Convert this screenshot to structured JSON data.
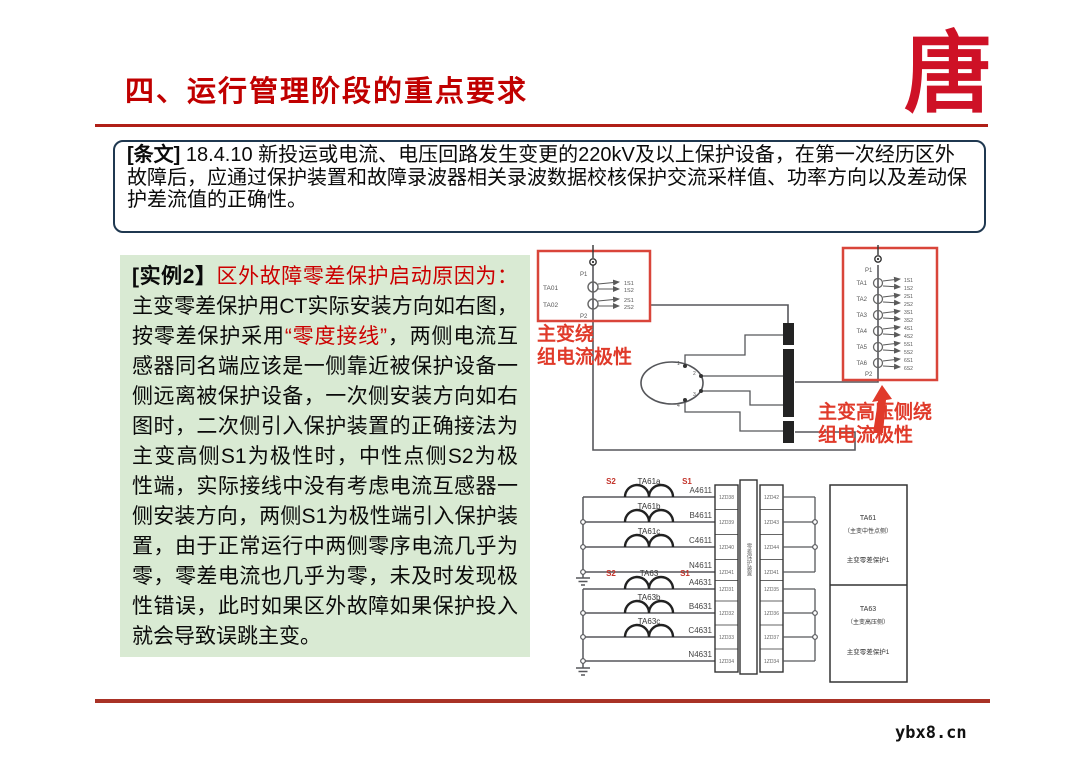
{
  "page": {
    "title": "四、运行管理阶段的重点要求",
    "watermark": "ybx8.cn",
    "logo_glyph": "唐",
    "colors": {
      "accent_red": "#C00000",
      "annotation_red": "#E03A2A",
      "green_bg": "#D9EAD3"
    }
  },
  "tiaowen": {
    "tag": "[条文]",
    "body": " 18.4.10 新投运或电流、电压回路发生变更的220kV及以上保护设备，在第一次经历区外故障后，应通过保护装置和故障录波器相关录波数据校核保护交流采样值、功率方向以及差动保护差流值的正确性。"
  },
  "example": {
    "tag": "[实例2】",
    "red_intro": "区外故障零差保护启动原因为：",
    "black_1": "主变零差保护用CT实际安装方向如右图，按零差保护采用",
    "red_quote": "“零度接线”",
    "black_2": "，两侧电流互感器同名端应该是一侧靠近被保护设备一侧远离被保护设备，一次侧安装方向如右图时，二次侧引入保护装置的正确接法为主变高侧S1为极性时，中性点侧S2为极性端，实际接线中没有考虑电流互感器一侧安装方向，两侧S1为极性端引入保护装置，由于正常运行中两侧零序电流几乎为零，零差电流也几乎为零，未及时发现极性错误，此时如果区外故障如果保护投入就会导致误跳主变。"
  },
  "diagram_top": {
    "left_box": {
      "p1": "P1",
      "p2": "P2",
      "cts": [
        {
          "name": "TA01",
          "t1": "1S1",
          "t2": "1S2"
        },
        {
          "name": "TA02",
          "t1": "2S1",
          "t2": "2S2"
        }
      ]
    },
    "left_caption_l1": "主变绕",
    "left_caption_l2": "组电流极性",
    "right_box": {
      "p1": "P1",
      "p2": "P2",
      "cts": [
        {
          "name": "TA1",
          "t1": "1S1",
          "t2": "1S2"
        },
        {
          "name": "TA2",
          "t1": "2S1",
          "t2": "2S2"
        },
        {
          "name": "TA3",
          "t1": "3S1",
          "t2": "3S2"
        },
        {
          "name": "TA4",
          "t1": "4S1",
          "t2": "4S2"
        },
        {
          "name": "TA5",
          "t1": "5S1",
          "t2": "5S2"
        },
        {
          "name": "TA6",
          "t1": "6S1",
          "t2": "6S2"
        }
      ]
    },
    "right_caption_l1": "主变高压侧绕",
    "right_caption_l2": "组电流极性",
    "winding_terminals": [
      "1",
      "2",
      "3",
      "4"
    ]
  },
  "diagram_bottom": {
    "polarity": {
      "s2": "S2",
      "s1": "S1"
    },
    "group1": {
      "cts": [
        "TA61a",
        "TA61b",
        "TA61c"
      ],
      "wires": [
        "A4611",
        "B4611",
        "C4611",
        "N4611"
      ]
    },
    "group2": {
      "cts": [
        "TA63",
        "TA63b",
        "TA63c"
      ],
      "wires": [
        "A4631",
        "B4631",
        "C4631",
        "N4631"
      ]
    },
    "terminal_left": [
      "1ZD38",
      "1ZD39",
      "1ZD40",
      "1ZD41",
      "1ZD31",
      "1ZD32",
      "1ZD33",
      "1ZD34"
    ],
    "terminal_right": [
      "1ZD42",
      "1ZD43",
      "1ZD44",
      "1ZD41",
      "1ZD35",
      "1ZD36",
      "1ZD37",
      "1ZD34"
    ],
    "terminal_center": "零差保护装置",
    "info_box": {
      "cell1": [
        "TA61",
        "（主变中性点侧）",
        "主变零差保护1"
      ],
      "cell2": [
        "TA63",
        "（主变高压侧）",
        "主变零差保护1"
      ]
    }
  }
}
